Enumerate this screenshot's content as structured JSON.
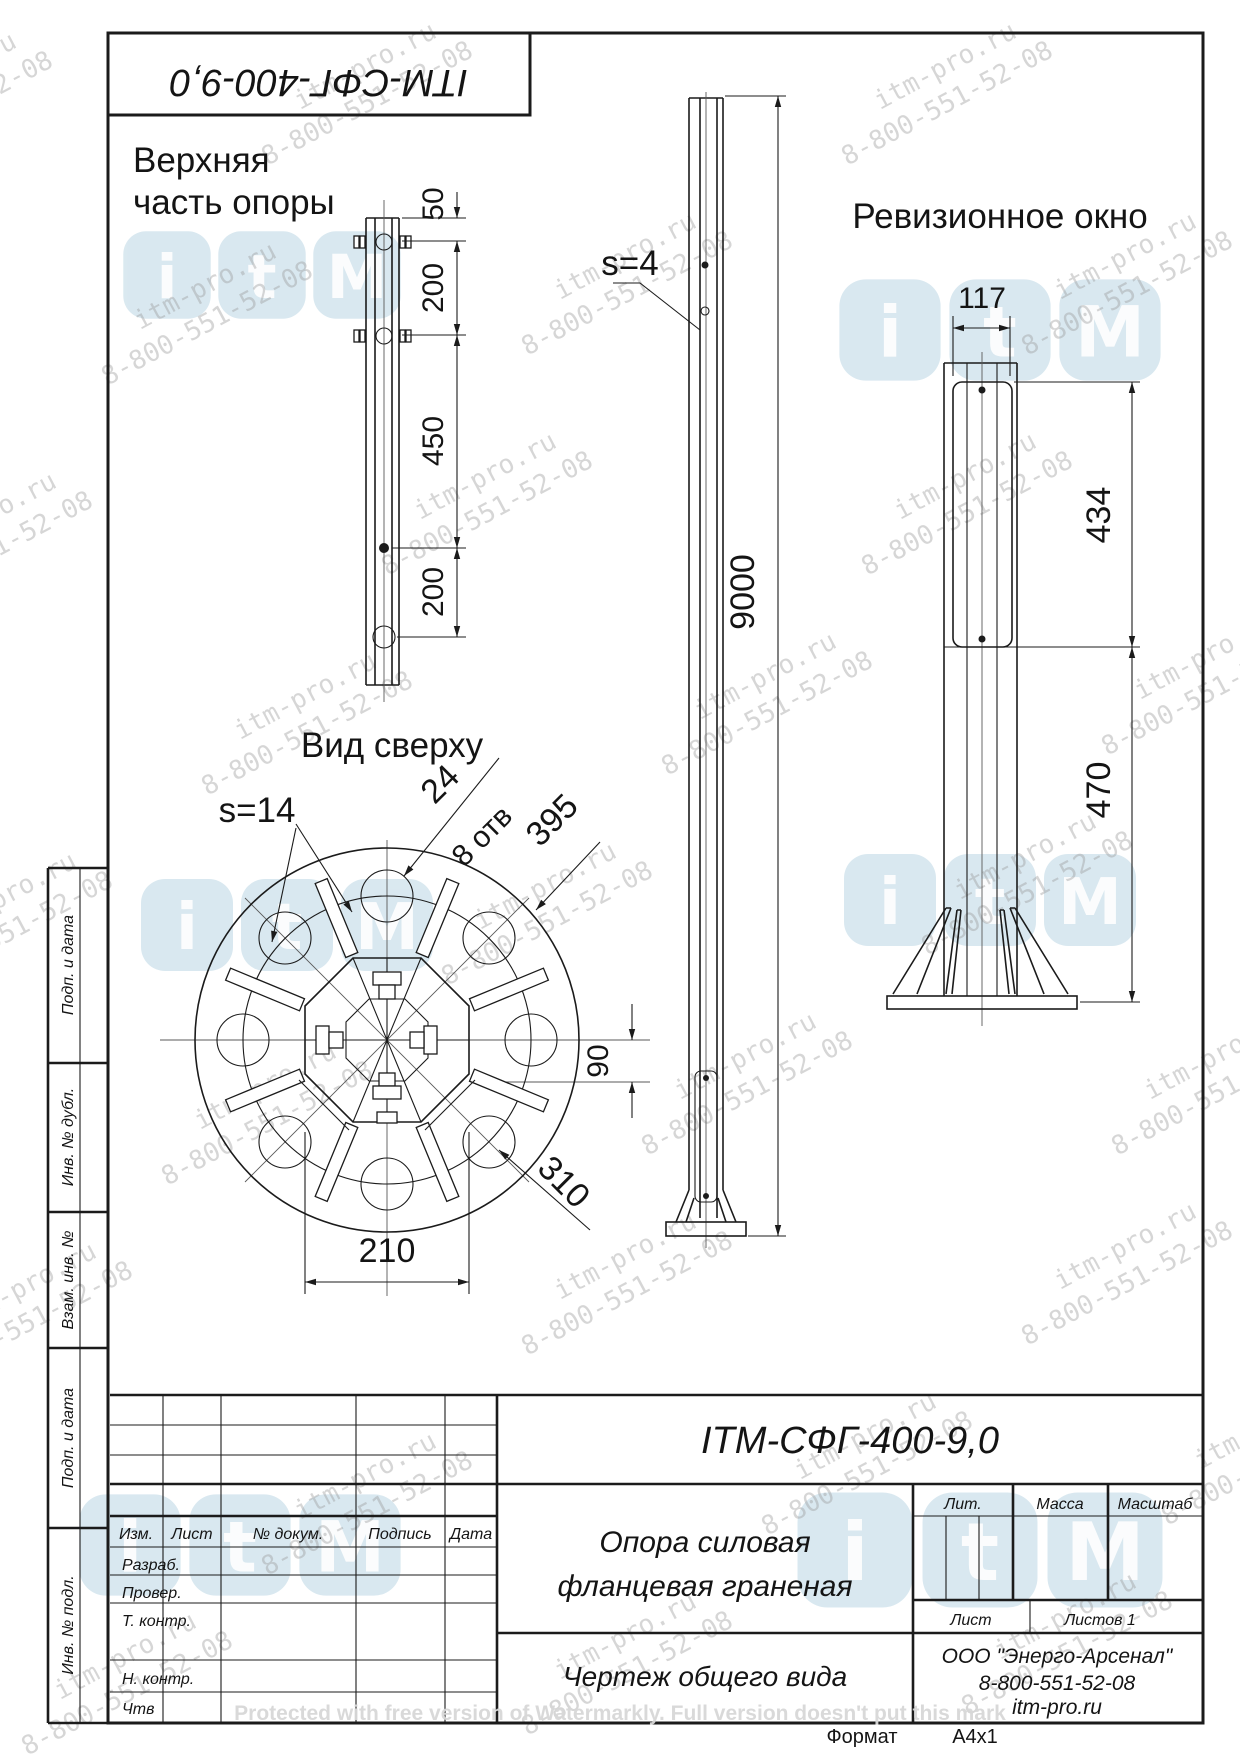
{
  "designation": "ITM-СФГ-400-9,0",
  "drawing_labels": {
    "upper_part_1": "Верхняя",
    "upper_part_2": "часть опоры",
    "revision_window": "Ревизионное окно",
    "top_view": "Вид сверху",
    "wall_s4": "s=4",
    "wall_s14": "s=14",
    "hole_size": "24",
    "hole_count": "8 отв"
  },
  "dims": {
    "top_50": "50",
    "top_200a": "200",
    "top_450": "450",
    "top_200b": "200",
    "height": "9000",
    "win_w": "117",
    "win_h": "434",
    "win_off": "470",
    "flange_d": "395",
    "bolt_gap": "90",
    "bolt_circle_d": "310",
    "flats": "210"
  },
  "side_column": {
    "c1": "Подп. и дата",
    "c2": "Инв. № дубл.",
    "c3": "Взам. инв. №",
    "c4": "Подп. и дата",
    "c5": "Инв. № подл."
  },
  "title_block": {
    "header": {
      "izm": "Изм.",
      "list": "Лист",
      "doc": "№ докум.",
      "sign": "Подпись",
      "date": "Дата"
    },
    "rows": {
      "dev": "Разраб.",
      "check": "Провер.",
      "tcontr": "Т. контр.",
      "ncontr": "Н. контр.",
      "approve": "Чтв"
    },
    "name_1": "Опора силовая",
    "name_2": "фланцевая граненая",
    "doc_type": "Чертеж общего вида",
    "lit": "Лит.",
    "mass": "Масса",
    "scale": "Масштаб",
    "sheet": "Лист",
    "sheets": "Листов 1",
    "company": "ООО \"Энерго-Арсенал\"",
    "phone": "8-800-551-52-08",
    "site": "itm-pro.ru",
    "format_label": "Формат",
    "format_value": "A4x1"
  },
  "watermark": {
    "line1": "itm-pro.ru",
    "line2": "8-800-551-52-08",
    "logo": "itM",
    "protect": "Protected with free version of Watermarkly. Full version doesn't put this mark"
  }
}
